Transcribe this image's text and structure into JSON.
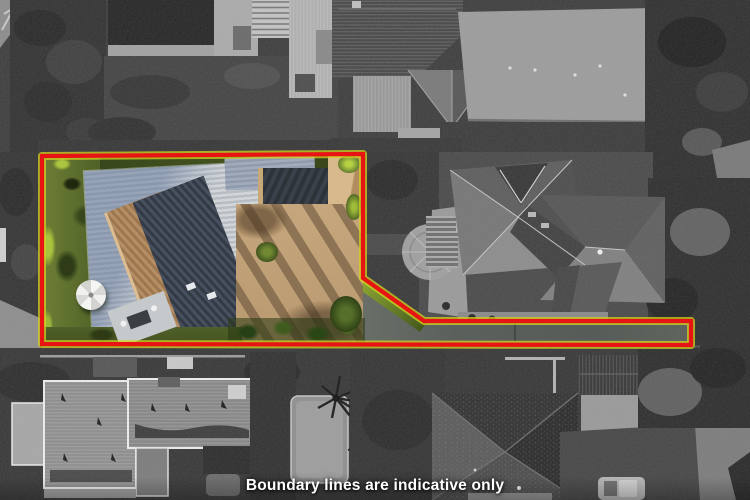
{
  "caption": {
    "text": "Boundary lines are indicative only"
  },
  "boundary": {
    "points": "42,156 363,154 363,278 424,321 691,321 691,345 42,344",
    "stroke_width": 4
  },
  "theme": {
    "boundary-red": "#e81414",
    "boundary-fringe": "#d3d41f",
    "caption-text": "#ffffff",
    "grass": "#4d5c28",
    "grass-bright": "#a9c53e",
    "roof-light-a": "#d3d6d9",
    "roof-light-b": "#b7bdc3",
    "roof-tan": "#b58e64",
    "roof-tan-dark": "#9c7750",
    "roof-charcoal-a": "#333a45",
    "roof-charcoal-b": "#47505e",
    "courtyard": "#c2a278",
    "carport": "#d2b286",
    "driveway": "#5b605c"
  }
}
